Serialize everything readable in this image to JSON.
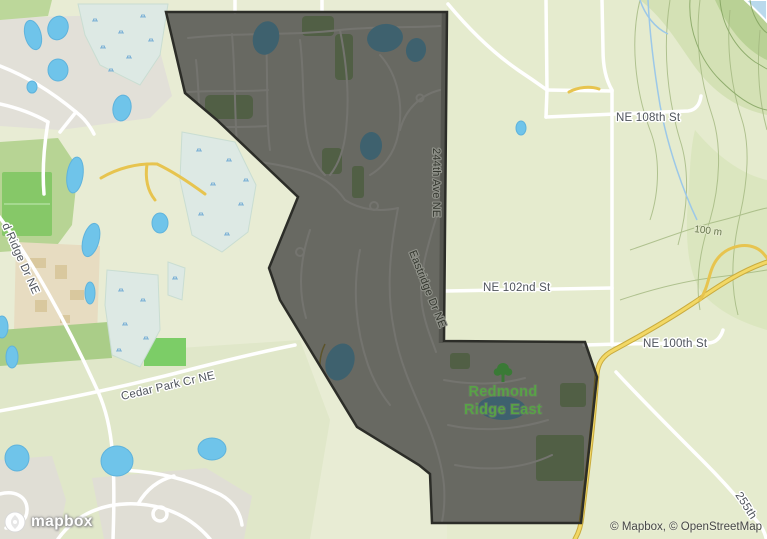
{
  "map": {
    "area_label": {
      "line1": "Redmond",
      "line2": "Ridge East"
    },
    "roads": {
      "ne_108th": "NE 108th St",
      "ne_102nd": "NE 102nd St",
      "ne_100th": "NE 100th St",
      "cedar_park": "Cedar Park Cr NE",
      "ave_244th": "244th Ave NE",
      "eastridge": "Eastridge Dr NE",
      "ridge_dr": "d Ridge Dr NE",
      "ave_255th": "255th"
    },
    "contour_label": "100 m",
    "footer": {
      "logo": "mapbox",
      "attribution": "© Mapbox, © OpenStreetMap"
    },
    "colors": {
      "land": "#e8ecd4",
      "water": "#6fc4ea",
      "wetland": "#dde9e4",
      "park_green": "#b7d494",
      "road_yellow": "#e7c44f",
      "selection_fill": "rgba(30,31,27,0.60)",
      "selection_border": "#2c2d28",
      "area_label_green": "#58a346"
    }
  }
}
